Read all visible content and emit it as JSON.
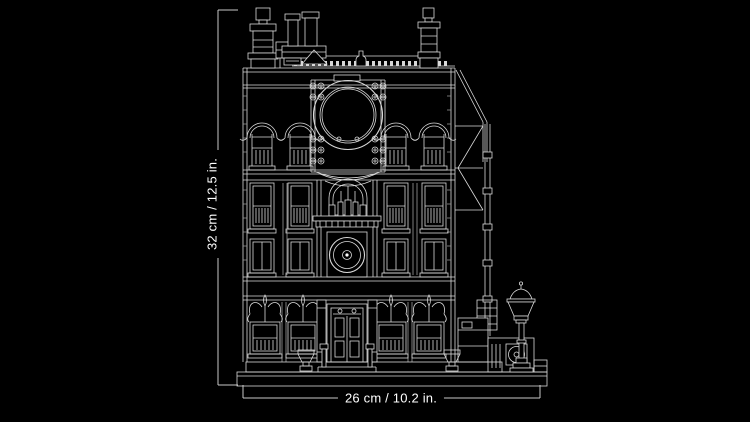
{
  "page": {
    "background_color": "#000000",
    "line_color": "#d9d9d9",
    "text_color": "#ffffff"
  },
  "drawing": {
    "name": "building-line-art",
    "description_label": ""
  },
  "dimensions": {
    "height_label": "32 cm / 12.5 in.",
    "width_label": "26 cm / 10.2 in."
  }
}
